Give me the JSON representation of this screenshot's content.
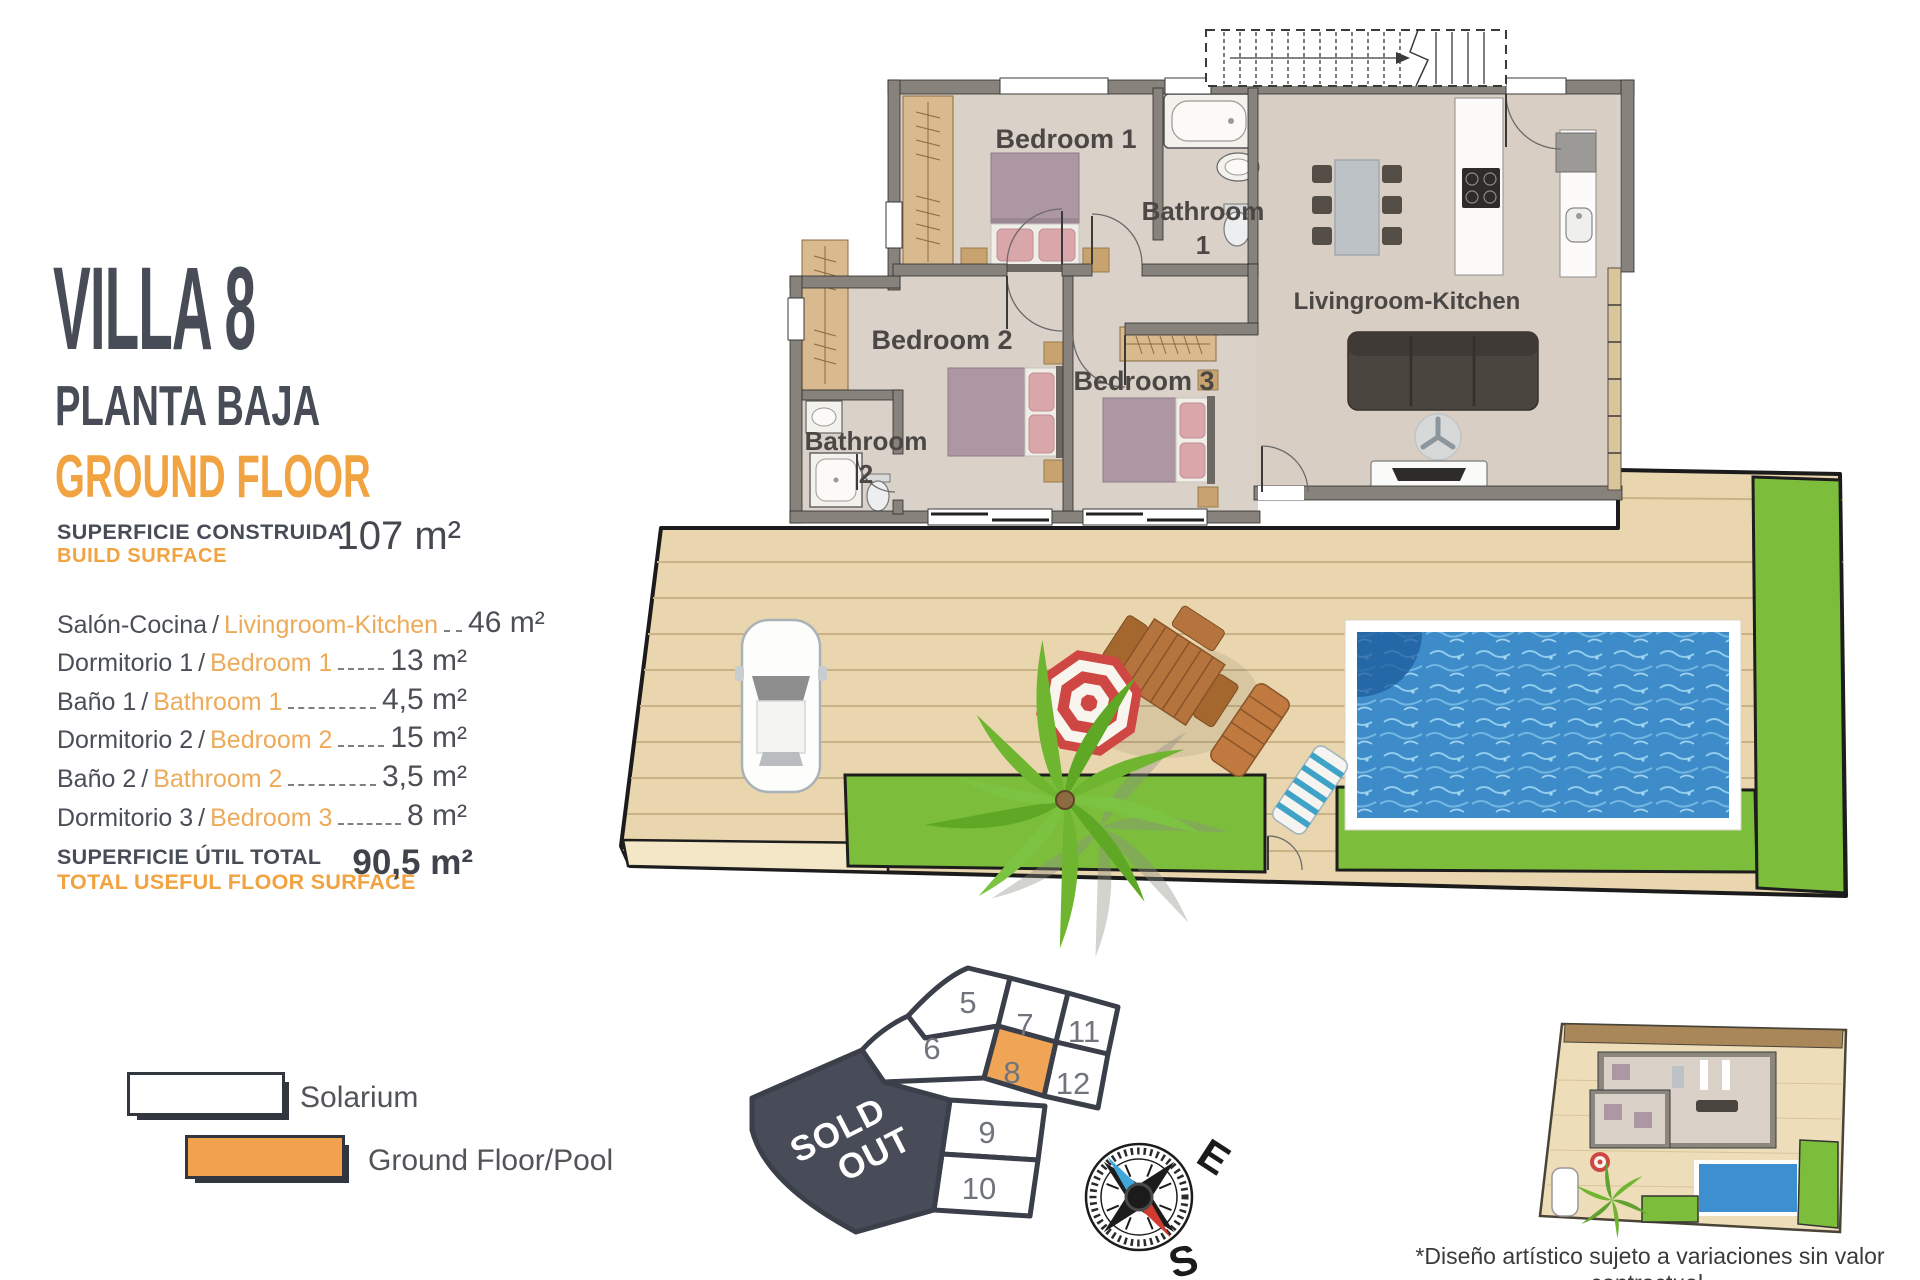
{
  "panel": {
    "title": "VILLA 8",
    "subtitle_es": "PLANTA BAJA",
    "subtitle_en": "GROUND FLOOR",
    "build_label_es": "SUPERFICIE CONSTRUIDA",
    "build_label_en": "BUILD SURFACE",
    "build_value": "107 m²",
    "sep": "/",
    "rooms": [
      {
        "es": "Salón-Cocina",
        "en": "Livingroom-Kitchen",
        "value": "46 m²"
      },
      {
        "es": "Dormitorio 1",
        "en": "Bedroom 1",
        "value": "13 m²"
      },
      {
        "es": "Baño 1",
        "en": "Bathroom 1",
        "value": "4,5 m²"
      },
      {
        "es": "Dormitorio 2",
        "en": "Bedroom 2",
        "value": "15 m²"
      },
      {
        "es": "Baño 2",
        "en": "Bathroom 2",
        "value": "3,5 m²"
      },
      {
        "es": "Dormitorio 3",
        "en": "Bedroom 3",
        "value": "8 m²"
      }
    ],
    "total_label_es": "SUPERFICIE ÚTIL TOTAL",
    "total_label_en": "TOTAL USEFUL FLOOR SURFACE",
    "total_value": "90,5 m²"
  },
  "legend": {
    "solarium": "Solarium",
    "ground_pool": "Ground Floor/Pool"
  },
  "plan": {
    "bedroom1": "Bedroom 1",
    "bathroom1_l1": "Bathroom",
    "bathroom1_l2": "1",
    "bedroom2": "Bedroom 2",
    "bedroom3": "Bedroom 3",
    "bathroom2_l1": "Bathroom",
    "bathroom2_l2": "2",
    "living": "Livingroom-Kitchen"
  },
  "site_map": {
    "lot5": "5",
    "lot6": "6",
    "lot7": "7",
    "lot8": "8",
    "lot9": "9",
    "lot10": "10",
    "lot11": "11",
    "lot12": "12",
    "sold_l1": "SOLD",
    "sold_l2": "OUT",
    "highlighted_lot": "8"
  },
  "compass": {
    "east": "E",
    "south": "S"
  },
  "footnote": {
    "line1": "*Diseño artístico sujeto a variaciones sin valor contractual.",
    "line2": "Muebles y paneles solares no incluidos"
  },
  "colors": {
    "accent_orange": "#F2A341",
    "dark": "#474C57",
    "deck": "#E9D6AE",
    "green": "#7CBE3B",
    "pool": "#3D8BC8",
    "sold_out": "#474C58",
    "wall_gray": "#87827B"
  }
}
